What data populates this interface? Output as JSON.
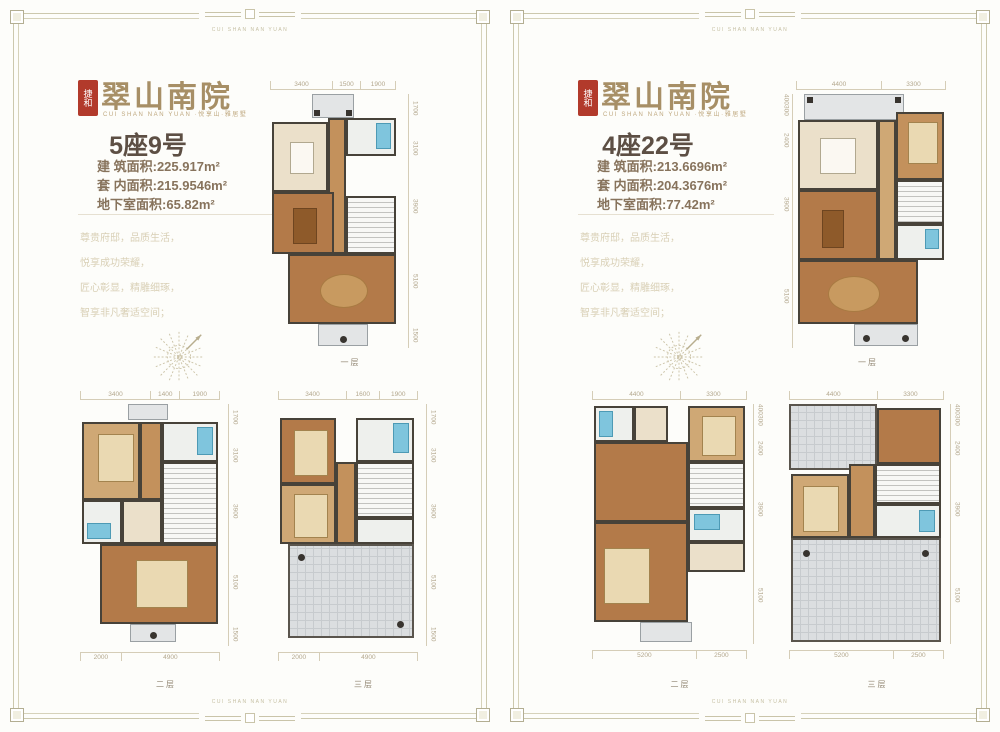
{
  "border": {
    "brand_text": "CUI SHAN NAN YUAN"
  },
  "brand": {
    "seal": "捷和",
    "logo": "翠山南院",
    "subtitle": "CUI SHAN NAN YUAN ·悦享山·雅居墅"
  },
  "marketing": {
    "lines": [
      "尊贵府邸，品质生活，",
      "悦享成功荣耀，",
      "匠心彰显，精雕细琢，",
      "智享非凡奢适空间；"
    ]
  },
  "panels": [
    {
      "unit": "5座9号",
      "areas": [
        {
          "label": "建 筑面积",
          "value": ":225.917m²"
        },
        {
          "label": "套 内面积",
          "value": ":215.9546m²"
        },
        {
          "label": "地下室面积",
          "value": ":65.82m²"
        }
      ],
      "floors": [
        {
          "label": "一层",
          "top": [
            "3400",
            "1500",
            "1900"
          ],
          "side": [
            "1700",
            "3100",
            "3900",
            "5100",
            "1500"
          ],
          "bottom": []
        },
        {
          "label": "二层",
          "top": [
            "3400",
            "1400",
            "1900"
          ],
          "side": [
            "1700",
            "3100",
            "3900",
            "5100",
            "1500"
          ],
          "bottom": [
            "2000",
            "4900"
          ]
        },
        {
          "label": "三层",
          "top": [
            "3400",
            "1600",
            "1900"
          ],
          "side": [
            "1700",
            "3100",
            "3900",
            "5100",
            "1500"
          ],
          "bottom": [
            "2000",
            "4900"
          ]
        }
      ]
    },
    {
      "unit": "4座22号",
      "areas": [
        {
          "label": "建 筑面积",
          "value": ":213.6696m²"
        },
        {
          "label": "套 内面积",
          "value": ":204.3676m²"
        },
        {
          "label": "地下室面积",
          "value": ":77.42m²"
        }
      ],
      "floors": [
        {
          "label": "一层",
          "top": [
            "4400",
            "3300"
          ],
          "side": [
            "400",
            "300",
            "2400",
            "3900",
            "5100"
          ],
          "bottom": []
        },
        {
          "label": "二层",
          "top": [
            "4400",
            "3300"
          ],
          "side": [
            "400",
            "300",
            "2400",
            "3900",
            "5100"
          ],
          "bottom": [
            "5200",
            "2500"
          ]
        },
        {
          "label": "三层",
          "top": [
            "4400",
            "3300"
          ],
          "side": [
            "400",
            "300",
            "2400",
            "3900",
            "5100"
          ],
          "bottom": [
            "5200",
            "2500"
          ]
        }
      ]
    }
  ],
  "colors": {
    "accent_gold": "#a78f66",
    "seal_red": "#b23a2b",
    "frame_olive": "#ccc8ad",
    "wood_floor": "#b37a49",
    "bath_blue": "#7fc5dd",
    "terrace_gray": "#dbdee0"
  }
}
